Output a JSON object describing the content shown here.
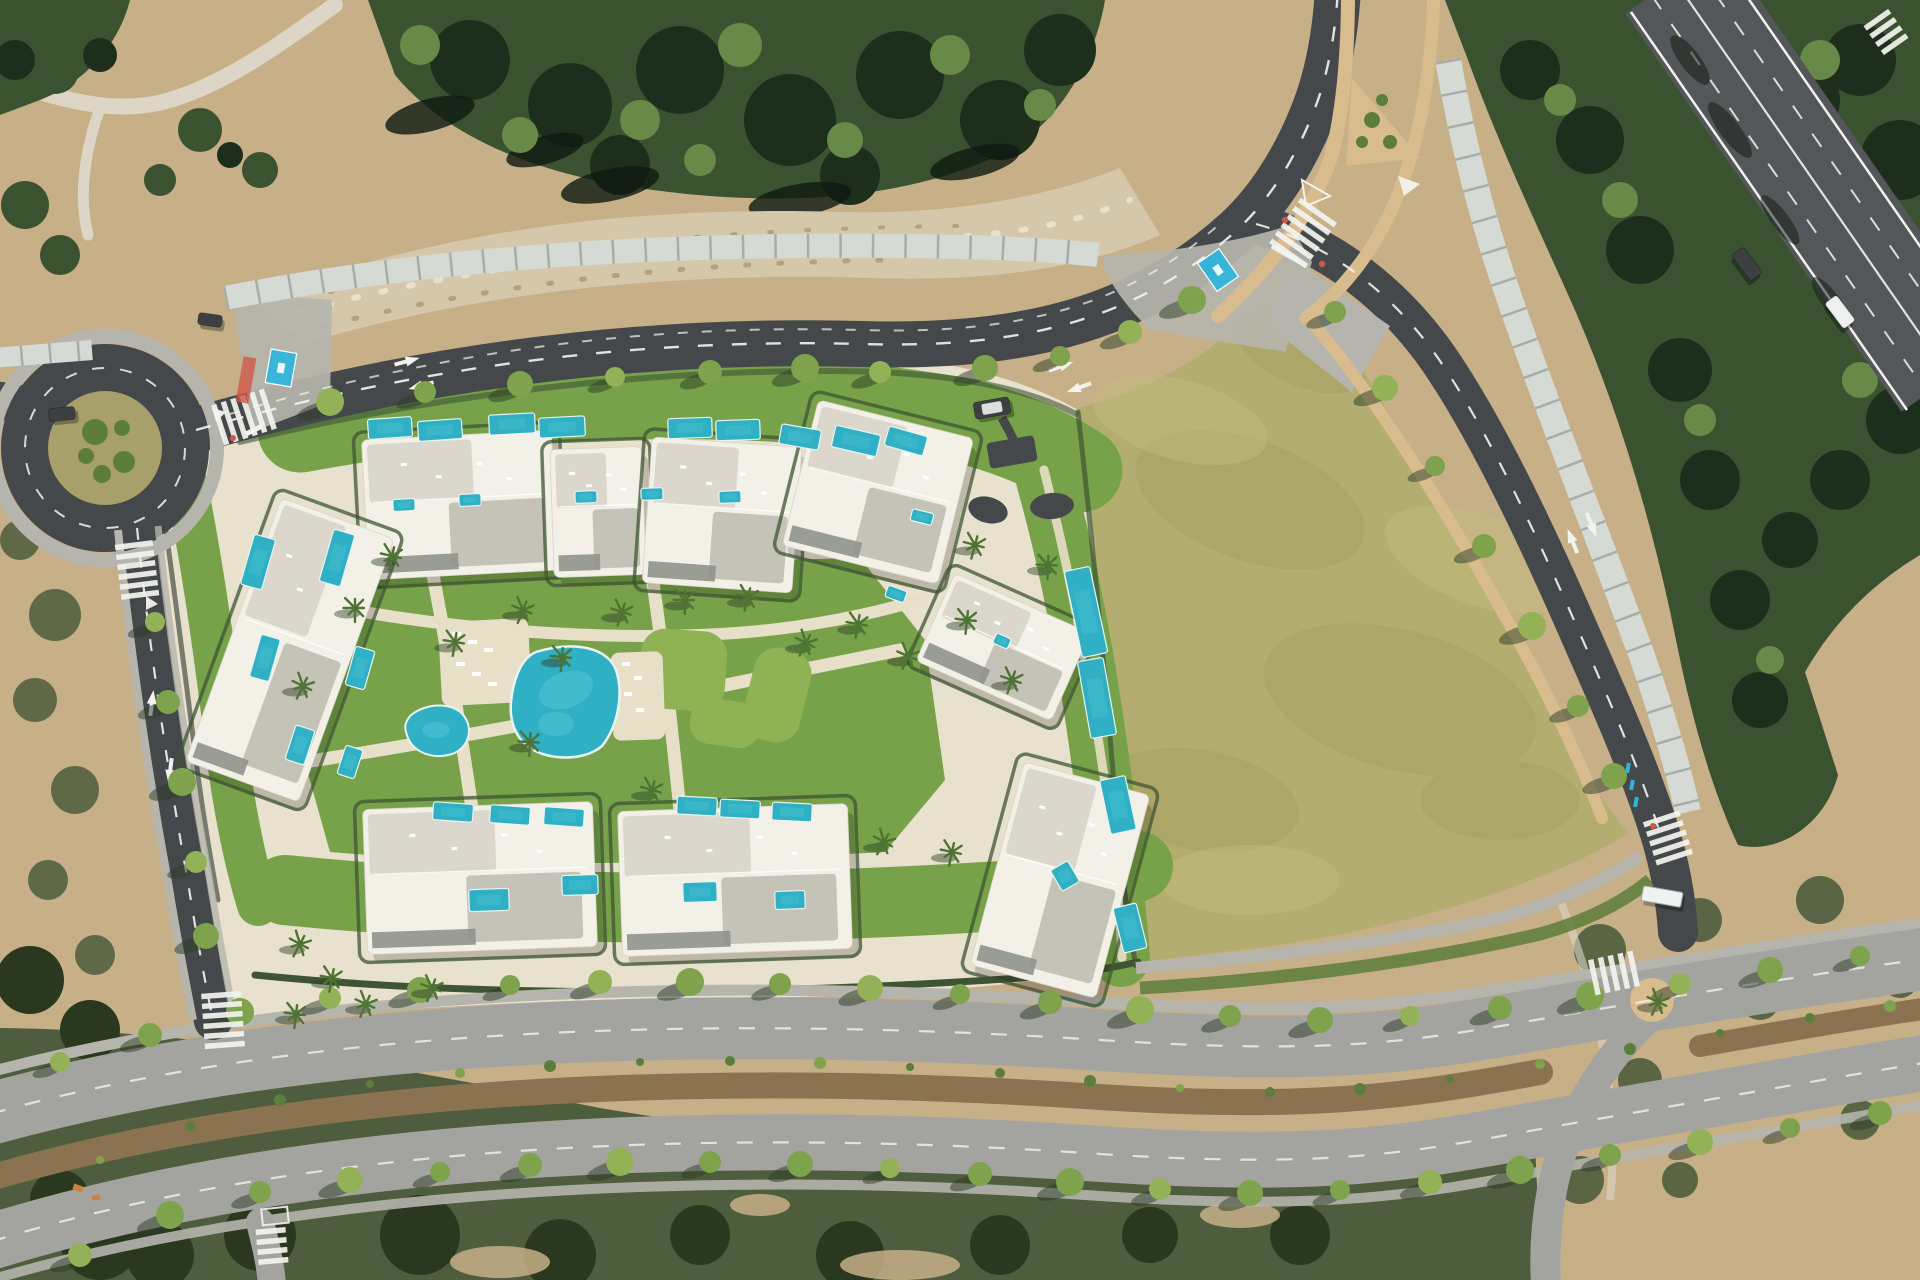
{
  "meta": {
    "kind": "aerial-satellite-render",
    "description": "Top-down aerial render of a Mediterranean residential development: a roundabout on the left, a curving main road with rows of covered parking, white apartment blocks with private turquoise pools around a communal garden and large pool, a big olive-green vacant plot, a diagonal highway in the top-right corner, and a tree-lined boulevard along the bottom.",
    "width": 1920,
    "height": 1280
  },
  "palette": {
    "base_dirt": "#c7af88",
    "dirt_light": "#ddd5c6",
    "scree": "#d5c8aa",
    "rock_dot": "#e9e1ca",
    "rock_dark": "#b3a27e",
    "forest": "#3b5230",
    "forest_dark": "#1e2e1c",
    "forest_black": "#0f1a10",
    "forest_light": "#688a48",
    "scrub": "#4e5d3d",
    "scrub_dark": "#2a381f",
    "field": "#b3ae6f",
    "field_dark": "#a29c60",
    "field_light": "#c0bb7e",
    "lawn": "#77a249",
    "lawn_bright": "#8fb254",
    "hardscape": "#e8e1cd",
    "path_cream": "#e7dfc8",
    "hedge": "#3f5433",
    "asphalt": "#45484a",
    "asphalt_light": "#a3a4a0",
    "highway": "#54575a",
    "median_dirt": "#8b7352",
    "marking": "#f2f3ee",
    "sidewalk_tan": "#d9bc8e",
    "paver": "#b5b5ad",
    "canopy": "#d6dad5",
    "canopy_gap": "#9aa39b",
    "wall_dark": "#5b6055",
    "building": "#f3f0e8",
    "roof_light": "#dbd7cc",
    "roof_mid": "#c5c2b7",
    "roof_dark": "#8f9389",
    "pool": "#2fb0c4",
    "pool_light": "#53c6d6",
    "pool_rim": "#e9f4f2",
    "tree": "#7fa34c",
    "tree_alt": "#93b258",
    "tree_shadow": "#2c3b26",
    "palm": "#4e7434",
    "shrub": "#5d7d3c",
    "inner_circle": "#a8a06b",
    "car_dark": "#3c4043",
    "car_white": "#eef0ef",
    "red": "#d2574a",
    "blue": "#30b4dc",
    "orange": "#cf7f3e"
  },
  "scene": {
    "landmarks": [
      "roundabout",
      "main-access-road",
      "covered-parking-rows",
      "residential-complex",
      "communal-pool",
      "kids-pool",
      "private-pools",
      "vacant-field",
      "highway",
      "boulevard-with-median",
      "crosswalks",
      "bus-shelter"
    ],
    "counts": {
      "residential_blocks": 9,
      "private_pools": 38,
      "communal_pools": 2,
      "crosswalks": 8,
      "vehicles": 5
    },
    "blocks": [
      {
        "x": 460,
        "y": 505,
        "w": 190,
        "h": 140,
        "rot": -3,
        "name": "block-north-1"
      },
      {
        "x": 598,
        "y": 512,
        "w": 92,
        "h": 128,
        "rot": -2,
        "name": "block-north-2"
      },
      {
        "x": 722,
        "y": 515,
        "w": 150,
        "h": 146,
        "rot": 4,
        "name": "block-north-3"
      },
      {
        "x": 878,
        "y": 492,
        "w": 160,
        "h": 150,
        "rot": 14,
        "name": "block-north-4"
      },
      {
        "x": 1003,
        "y": 647,
        "w": 148,
        "h": 96,
        "rot": 24,
        "name": "block-east-1"
      },
      {
        "x": 1060,
        "y": 880,
        "w": 130,
        "h": 210,
        "rot": 15,
        "name": "block-east-2"
      },
      {
        "x": 290,
        "y": 650,
        "w": 120,
        "h": 280,
        "rot": 20,
        "name": "block-west"
      },
      {
        "x": 480,
        "y": 878,
        "w": 230,
        "h": 145,
        "rot": -2,
        "name": "block-south-1"
      },
      {
        "x": 735,
        "y": 880,
        "w": 230,
        "h": 145,
        "rot": -2,
        "name": "block-south-2"
      }
    ],
    "private_pools": [
      [
        390,
        428,
        44,
        20,
        -4
      ],
      [
        440,
        430,
        44,
        20,
        -4
      ],
      [
        512,
        424,
        46,
        20,
        -3
      ],
      [
        562,
        427,
        46,
        20,
        -3
      ],
      [
        690,
        428,
        44,
        20,
        -2
      ],
      [
        738,
        430,
        44,
        20,
        -2
      ],
      [
        800,
        437,
        40,
        20,
        10
      ],
      [
        856,
        441,
        46,
        22,
        13
      ],
      [
        906,
        441,
        40,
        20,
        16
      ],
      [
        1086,
        612,
        26,
        88,
        -12
      ],
      [
        1097,
        698,
        26,
        78,
        -10
      ],
      [
        1118,
        805,
        26,
        55,
        -12
      ],
      [
        1065,
        876,
        20,
        24,
        -30
      ],
      [
        1130,
        928,
        24,
        46,
        -14
      ],
      [
        258,
        562,
        22,
        52,
        16
      ],
      [
        337,
        558,
        22,
        54,
        16
      ],
      [
        265,
        658,
        20,
        44,
        16
      ],
      [
        360,
        668,
        20,
        40,
        16
      ],
      [
        300,
        745,
        20,
        36,
        18
      ],
      [
        350,
        762,
        18,
        30,
        18
      ],
      [
        453,
        812,
        40,
        18,
        4
      ],
      [
        510,
        815,
        40,
        18,
        4
      ],
      [
        564,
        817,
        40,
        18,
        4
      ],
      [
        697,
        806,
        40,
        18,
        3
      ],
      [
        740,
        809,
        40,
        18,
        3
      ],
      [
        792,
        812,
        40,
        18,
        3
      ],
      [
        489,
        900,
        40,
        22,
        -2
      ],
      [
        580,
        885,
        36,
        20,
        -2
      ],
      [
        700,
        892,
        34,
        20,
        -2
      ],
      [
        790,
        900,
        30,
        18,
        -2
      ],
      [
        404,
        505,
        22,
        12,
        -3
      ],
      [
        470,
        500,
        22,
        12,
        -3
      ],
      [
        586,
        497,
        22,
        12,
        -2
      ],
      [
        652,
        494,
        22,
        12,
        -2
      ],
      [
        730,
        497,
        22,
        12,
        -2
      ],
      [
        922,
        517,
        22,
        12,
        14
      ],
      [
        896,
        594,
        20,
        12,
        20
      ],
      [
        1002,
        641,
        16,
        11,
        24
      ]
    ],
    "street_trees": [
      [
        60,
        1062
      ],
      [
        150,
        1035
      ],
      [
        240,
        1012
      ],
      [
        330,
        998
      ],
      [
        420,
        990
      ],
      [
        510,
        985
      ],
      [
        600,
        982
      ],
      [
        690,
        982
      ],
      [
        780,
        984
      ],
      [
        870,
        988
      ],
      [
        960,
        994
      ],
      [
        1050,
        1002
      ],
      [
        1140,
        1010
      ],
      [
        1230,
        1016
      ],
      [
        1320,
        1020
      ],
      [
        1410,
        1016
      ],
      [
        1500,
        1008
      ],
      [
        1590,
        996
      ],
      [
        1680,
        984
      ],
      [
        1770,
        970
      ],
      [
        1860,
        956
      ],
      [
        80,
        1255
      ],
      [
        170,
        1215
      ],
      [
        260,
        1192
      ],
      [
        350,
        1180
      ],
      [
        440,
        1172
      ],
      [
        530,
        1165
      ],
      [
        620,
        1162
      ],
      [
        710,
        1162
      ],
      [
        800,
        1164
      ],
      [
        890,
        1168
      ],
      [
        980,
        1174
      ],
      [
        1070,
        1182
      ],
      [
        1160,
        1189
      ],
      [
        1250,
        1193
      ],
      [
        1340,
        1190
      ],
      [
        1430,
        1182
      ],
      [
        1520,
        1170
      ],
      [
        1610,
        1155
      ],
      [
        1700,
        1142
      ],
      [
        1790,
        1128
      ],
      [
        1880,
        1113
      ],
      [
        330,
        402
      ],
      [
        425,
        392
      ],
      [
        520,
        384
      ],
      [
        615,
        377
      ],
      [
        710,
        372
      ],
      [
        805,
        368
      ],
      [
        880,
        372
      ],
      [
        985,
        368
      ],
      [
        1060,
        356
      ],
      [
        1130,
        332
      ],
      [
        1192,
        300
      ],
      [
        1335,
        312
      ],
      [
        1385,
        388
      ],
      [
        1435,
        466
      ],
      [
        1484,
        546
      ],
      [
        1532,
        626
      ],
      [
        1578,
        706
      ],
      [
        1614,
        776
      ],
      [
        155,
        622
      ],
      [
        168,
        702
      ],
      [
        182,
        782
      ],
      [
        196,
        862
      ],
      [
        206,
        936
      ]
    ],
    "median_shrubs": [
      [
        100,
        1160
      ],
      [
        190,
        1126
      ],
      [
        280,
        1100
      ],
      [
        370,
        1084
      ],
      [
        460,
        1073
      ],
      [
        550,
        1066
      ],
      [
        640,
        1062
      ],
      [
        730,
        1061
      ],
      [
        820,
        1063
      ],
      [
        910,
        1067
      ],
      [
        1000,
        1073
      ],
      [
        1090,
        1081
      ],
      [
        1180,
        1088
      ],
      [
        1270,
        1092
      ],
      [
        1360,
        1089
      ],
      [
        1450,
        1079
      ],
      [
        1540,
        1064
      ],
      [
        1630,
        1049
      ],
      [
        1720,
        1033
      ],
      [
        1810,
        1018
      ],
      [
        1890,
        1006
      ]
    ],
    "palms": [
      [
        355,
        608
      ],
      [
        392,
        556
      ],
      [
        303,
        686
      ],
      [
        455,
        642
      ],
      [
        523,
        610
      ],
      [
        562,
        657
      ],
      [
        622,
        612
      ],
      [
        685,
        600
      ],
      [
        748,
        597
      ],
      [
        806,
        643
      ],
      [
        858,
        624
      ],
      [
        908,
        656
      ],
      [
        967,
        620
      ],
      [
        1012,
        680
      ],
      [
        1048,
        565
      ],
      [
        975,
        545
      ],
      [
        300,
        944
      ],
      [
        332,
        978
      ],
      [
        366,
        1004
      ],
      [
        296,
        1014
      ],
      [
        432,
        988
      ],
      [
        530,
        742
      ],
      [
        652,
        790
      ],
      [
        884,
        842
      ],
      [
        952,
        852
      ],
      [
        1658,
        1002
      ]
    ],
    "crosswalks": [
      {
        "x": 244,
        "y": 417,
        "rot": 72,
        "bars": 6,
        "len": 42,
        "name": "crosswalk-roundabout-east"
      },
      {
        "x": 137,
        "y": 570,
        "rot": -7,
        "bars": 6,
        "len": 38,
        "name": "crosswalk-left-road-top"
      },
      {
        "x": 223,
        "y": 1020,
        "rot": -4,
        "bars": 6,
        "len": 40,
        "name": "crosswalk-left-road-boulevard"
      },
      {
        "x": 1303,
        "y": 233,
        "rot": 35,
        "bars": 6,
        "len": 44,
        "name": "crosswalk-north-junction"
      },
      {
        "x": 1668,
        "y": 838,
        "rot": -18,
        "bars": 5,
        "len": 38,
        "name": "crosswalk-right-road-south"
      },
      {
        "x": 272,
        "y": 1246,
        "rot": -5,
        "bars": 4,
        "len": 30,
        "name": "crosswalk-boulevard-branch"
      },
      {
        "x": 1614,
        "y": 973,
        "rot": 78,
        "bars": 5,
        "len": 36,
        "name": "crosswalk-boulevard-east"
      },
      {
        "x": 1886,
        "y": 32,
        "rot": -35,
        "bars": 4,
        "len": 30,
        "name": "crosswalk-highway-corner"
      }
    ],
    "cars": [
      {
        "x": 992,
        "y": 408,
        "rot": -10,
        "w": 36,
        "h": 17,
        "body": "car_dark",
        "top": "car_white",
        "name": "suv-on-main-road"
      },
      {
        "x": 62,
        "y": 414,
        "rot": -6,
        "w": 26,
        "h": 13,
        "body": "car_dark",
        "top": "car_dark",
        "name": "car-west-arm"
      },
      {
        "x": 210,
        "y": 320,
        "rot": 8,
        "w": 24,
        "h": 12,
        "body": "car_dark",
        "top": "car_dark",
        "name": "car-parked-apron"
      },
      {
        "x": 1747,
        "y": 264,
        "rot": 53,
        "w": 32,
        "h": 15,
        "body": "car_dark",
        "top": "car_dark",
        "name": "car-highway-1"
      },
      {
        "x": 1840,
        "y": 312,
        "rot": 53,
        "w": 32,
        "h": 15,
        "body": "car_white",
        "top": "car_white",
        "name": "car-highway-2"
      }
    ],
    "handicap_spots": [
      {
        "x": 281,
        "y": 368,
        "rot": 10,
        "name": "handicap-parking-west"
      },
      {
        "x": 1218,
        "y": 270,
        "rot": -35,
        "name": "handicap-parking-east"
      }
    ]
  }
}
